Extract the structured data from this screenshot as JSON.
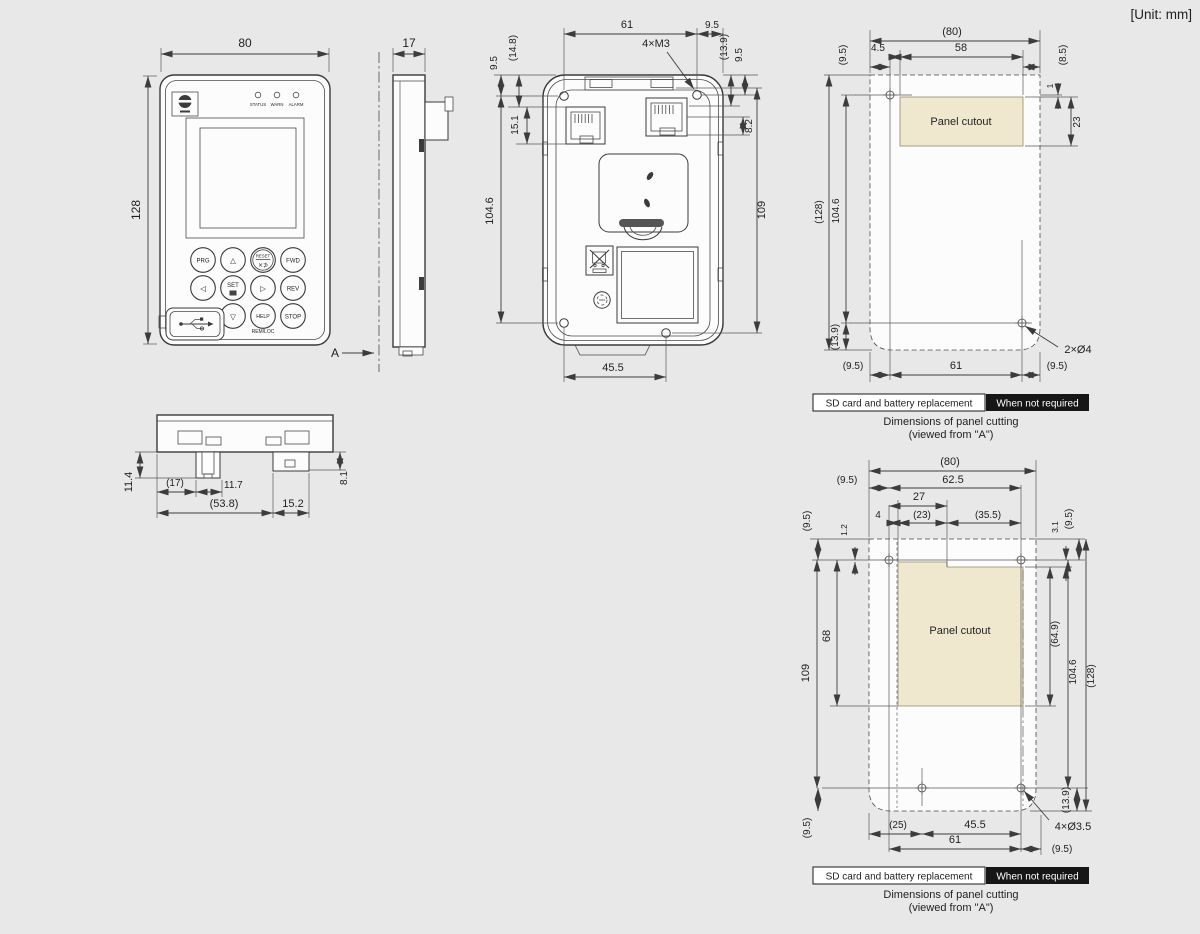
{
  "unit": "[Unit: mm]",
  "colors": {
    "background": "#e8e8e8",
    "panel_cutout_fill": "#efe8cf",
    "highlight_tag_bg": "#161616",
    "line": "#3a3a3a"
  },
  "front": {
    "w": "80",
    "h": "128",
    "leds": {
      "status": "STATUS",
      "warn": "WARN",
      "alarm": "ALARM"
    },
    "keys": {
      "prg": "PRG",
      "up": "△",
      "reset": "RESET",
      "reset_sub": "×⊅",
      "fwd": "FWD",
      "left": "◁",
      "set": "SET",
      "right": "▷",
      "rev": "REV",
      "down": "▽",
      "help": "HELP",
      "stop": "STOP",
      "remloc": "REM/LOC"
    }
  },
  "side": {
    "w": "17",
    "section": "A"
  },
  "back": {
    "d61": "61",
    "d95t": "9.5",
    "screws": "4×M3",
    "d148": "(14.8)",
    "d95l": "9.5",
    "d151": "15.1",
    "d1046": "104.6",
    "d139": "(13.9)",
    "d95r": "9.5",
    "d82": "8.2",
    "d109": "109",
    "d455": "45.5"
  },
  "bottomv": {
    "d114": "11.4",
    "d17": "(17)",
    "d117": "11.7",
    "d538": "(53.8)",
    "d152": "15.2",
    "d81": "8.1"
  },
  "c1": {
    "d80": "(80)",
    "d45": "4.5",
    "d58": "58",
    "d95tl": "(9.5)",
    "d85": "(8.5)",
    "d1": "1",
    "d23": "23",
    "d128": "(128)",
    "d1046": "104.6",
    "d139": "(13.9)",
    "d95bl": "(9.5)",
    "d61": "61",
    "d95br": "(9.5)",
    "holes": "2×Ø4",
    "cutout": "Panel cutout",
    "tag1": "SD card and battery replacement",
    "tag2": "When not required",
    "cap1": "Dimensions of panel cutting",
    "cap2": "(viewed from \"A\")"
  },
  "c2": {
    "d80": "(80)",
    "d625": "62.5",
    "d95tl": "(9.5)",
    "d27": "27",
    "d4": "4",
    "d23": "(23)",
    "d355": "(35.5)",
    "d95l": "(9.5)",
    "d12": "1.2",
    "d31": "3.1",
    "d95tr": "(9.5)",
    "d68": "68",
    "d109": "109",
    "d649": "(64.9)",
    "d1046": "104.6",
    "d128": "(128)",
    "d139": "(13.9)",
    "d95bl": "(9.5)",
    "d25": "(25)",
    "d455": "45.5",
    "d61": "61",
    "d95br": "(9.5)",
    "holes": "4×Ø3.5",
    "cutout": "Panel cutout",
    "tag1": "SD card and battery replacement",
    "tag2": "When not required",
    "cap1": "Dimensions of panel cutting",
    "cap2": "(viewed from \"A\")"
  }
}
